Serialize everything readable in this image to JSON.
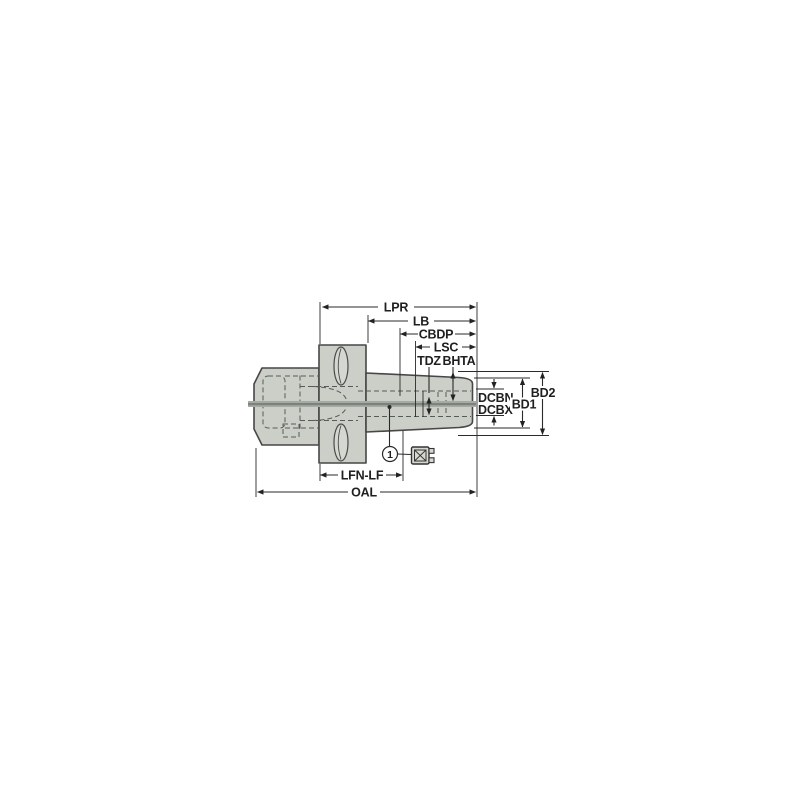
{
  "labels": {
    "lpr": "LPR",
    "lb": "LB",
    "cbdp": "CBDP",
    "lsc": "LSC",
    "tdz": "TDZ",
    "bhta": "BHTA",
    "dcbn_dcbx_line1": "DCBN-",
    "dcbn_dcbx_line2": "DCBX",
    "bd1": "BD1",
    "bd2": "BD2",
    "lfn_lf": "LFN-LF",
    "oal": "OAL",
    "balloon_1": "1"
  },
  "colors": {
    "background": "#ffffff",
    "body_fill": "#cccfc7",
    "slot_fill": "#d4d8d0",
    "outline": "#474747",
    "dimension_line": "#2a2a2a",
    "hidden_line": "#565b58",
    "centerline_band": "#a6aba4",
    "centerline_core": "#7c827c",
    "text": "#1f1f1f"
  }
}
